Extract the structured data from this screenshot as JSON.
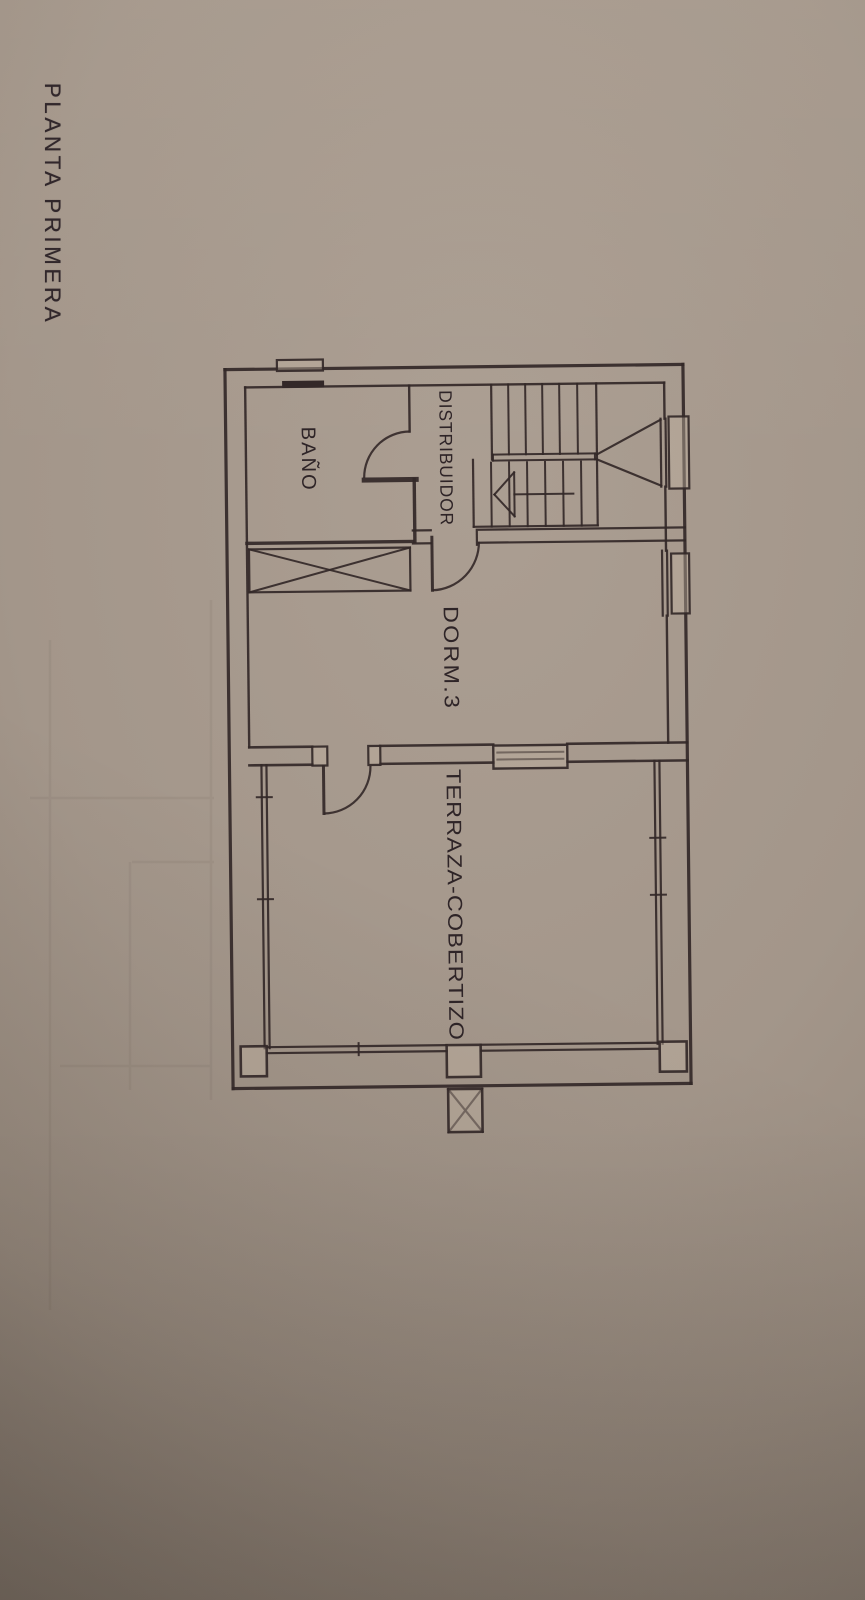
{
  "page": {
    "title": "PLANTA PRIMERA"
  },
  "floor_plan": {
    "ink": "#332828",
    "paper_fill": "rgba(192,178,162,0.42)",
    "skew_deg": -0.65,
    "rooms": [
      {
        "id": "bano",
        "label": "BAÑO",
        "x": 305,
        "y": 425,
        "length": 65,
        "size": 20,
        "ls": 2
      },
      {
        "id": "distribuidor",
        "label": "DISTRIBUIDOR",
        "x": 443,
        "y": 390,
        "length": 136,
        "size": 18,
        "ls": 1
      },
      {
        "id": "dorm3",
        "label": "DORM.3",
        "x": 445,
        "y": 606,
        "length": 104,
        "size": 21,
        "ls": 2
      },
      {
        "id": "terraza",
        "label": "TERRAZA-COBERTIZO",
        "x": 446,
        "y": 769,
        "length": 272,
        "size": 20.5,
        "ls": 1
      }
    ],
    "lines": [
      [
        229,
        367,
        229,
        1086,
        3.2,
        "outer-wall-left"
      ],
      [
        229,
        367,
        687,
        367,
        3.2,
        "outer-wall-top"
      ],
      [
        687,
        367,
        687,
        1086,
        3.2,
        "outer-wall-right"
      ],
      [
        229,
        1086,
        687,
        1086,
        3.2,
        "outer-wall-bottom"
      ],
      [
        249,
        385,
        249,
        745,
        2.4,
        "inner-wall-left"
      ],
      [
        249,
        385,
        668,
        385,
        2.4,
        "inner-wall-top"
      ],
      [
        668,
        385,
        668,
        421,
        2.4,
        "inner-wall-right-a"
      ],
      [
        668,
        489,
        668,
        553,
        2.4,
        "inner-wall-right-b"
      ],
      [
        668,
        618,
        668,
        745,
        2.4,
        "inner-wall-right-c"
      ],
      [
        413,
        385,
        413,
        431,
        2.4,
        "bano-right-wall"
      ],
      [
        367,
        479,
        419,
        479,
        5,
        "bano-door-stub"
      ],
      [
        417,
        479,
        417,
        541,
        3.4,
        "corridor-left-wall"
      ],
      [
        249,
        541,
        415,
        541,
        3.4,
        "bano-bottom-wall"
      ],
      [
        251,
        547,
        412,
        590,
        2,
        "wardrobe-diagonal"
      ],
      [
        251,
        590,
        412,
        547,
        2,
        "wardrobe-diagonal"
      ],
      [
        415,
        530,
        433,
        530,
        2.2,
        "corridor-bottom-wall"
      ],
      [
        415,
        543,
        433,
        543,
        2.2,
        "corridor-bottom-wall"
      ],
      [
        434,
        537,
        434,
        590,
        3,
        "dorm3-door-leaf"
      ],
      [
        479,
        530,
        479,
        545,
        2.2,
        "dorm3-door-jamb"
      ],
      [
        481,
        530,
        687,
        530,
        2.2,
        "stair-bottom-wall"
      ],
      [
        481,
        543,
        687,
        543,
        2.2,
        "stair-bottom-wall"
      ],
      [
        495,
        385,
        495,
        460,
        2.2,
        "stair-left-wall-upper"
      ],
      [
        476,
        460,
        476,
        527,
        2.2,
        "stair-left-wall-lower"
      ],
      [
        600,
        385,
        600,
        527,
        2.2,
        "stair-right-wall"
      ],
      [
        476,
        527,
        600,
        527,
        2.2,
        "stair-bottom-edge"
      ],
      [
        512,
        385,
        512,
        455,
        2,
        "stair-tread"
      ],
      [
        529,
        385,
        529,
        455,
        2,
        "stair-tread"
      ],
      [
        546,
        385,
        546,
        455,
        2,
        "stair-tread"
      ],
      [
        563,
        385,
        563,
        455,
        2,
        "stair-tread"
      ],
      [
        581,
        385,
        581,
        455,
        2,
        "stair-tread"
      ],
      [
        496,
        455,
        598,
        455,
        2,
        "stair-handrail"
      ],
      [
        496,
        461,
        598,
        461,
        2,
        "stair-handrail"
      ],
      [
        496,
        455,
        496,
        461,
        2,
        "stair-handrail-cap"
      ],
      [
        598,
        455,
        598,
        461,
        2,
        "stair-handrail-cap"
      ],
      [
        494,
        463,
        494,
        527,
        2,
        "stair-tread"
      ],
      [
        512,
        463,
        512,
        527,
        2,
        "stair-tread"
      ],
      [
        530,
        463,
        530,
        527,
        2,
        "stair-tread"
      ],
      [
        548,
        463,
        548,
        527,
        2,
        "stair-tread"
      ],
      [
        566,
        463,
        566,
        527,
        2,
        "stair-tread"
      ],
      [
        584,
        463,
        584,
        527,
        2,
        "stair-tread"
      ],
      [
        517,
        473,
        517,
        517,
        2,
        "stair-arrow-base"
      ],
      [
        517,
        473,
        497,
        495,
        2,
        "stair-arrow-head"
      ],
      [
        517,
        517,
        497,
        495,
        2,
        "stair-arrow-head"
      ],
      [
        517,
        495,
        576,
        495,
        2,
        "stair-arrow-shaft"
      ],
      [
        600,
        456,
        664,
        422,
        2.2,
        "stair-landing-splay"
      ],
      [
        600,
        461,
        664,
        488,
        2.2,
        "stair-landing-splay"
      ],
      [
        664,
        421,
        664,
        489,
        2.2,
        "stair-window"
      ],
      [
        669,
        421,
        669,
        489,
        2.2,
        "stair-window"
      ],
      [
        664,
        553,
        664,
        618,
        2.2,
        "dorm3-window"
      ],
      [
        669,
        553,
        669,
        618,
        2.2,
        "dorm3-window"
      ],
      [
        249,
        745,
        312,
        745,
        2.6,
        "dorm3-bottom-wall"
      ],
      [
        380,
        745,
        493,
        745,
        2.6,
        "dorm3-bottom-wall"
      ],
      [
        567,
        745,
        687,
        745,
        2.6,
        "dorm3-bottom-wall"
      ],
      [
        249,
        763,
        312,
        763,
        2.6,
        "dorm3-bottom-wall"
      ],
      [
        380,
        763,
        493,
        763,
        2.6,
        "dorm3-bottom-wall"
      ],
      [
        567,
        763,
        687,
        763,
        2.6,
        "dorm3-bottom-wall"
      ],
      [
        497,
        753,
        563,
        753,
        2,
        "terraza-window-pane"
      ],
      [
        497,
        760,
        563,
        760,
        2,
        "terraza-window-pane"
      ],
      [
        323,
        765,
        323,
        812,
        3,
        "terraza-door-leaf"
      ],
      [
        261,
        763,
        261,
        1046,
        2.2,
        "terraza-wall-left"
      ],
      [
        266,
        763,
        266,
        1046,
        2.2,
        "terraza-wall-left"
      ],
      [
        654,
        763,
        654,
        1046,
        2.2,
        "terraza-wall-right"
      ],
      [
        659,
        763,
        659,
        1046,
        2.2,
        "terraza-wall-right"
      ],
      [
        263,
        1045,
        443,
        1045,
        2.2,
        "terraza-wall-bottom"
      ],
      [
        263,
        1051,
        443,
        1051,
        2.2,
        "terraza-wall-bottom"
      ],
      [
        477,
        1045,
        654,
        1045,
        2.2,
        "terraza-wall-bottom"
      ],
      [
        477,
        1051,
        654,
        1051,
        2.2,
        "terraza-wall-bottom"
      ],
      [
        355,
        1042,
        355,
        1054,
        2,
        "terraza-wall-tick"
      ],
      [
        256,
        795,
        271,
        795,
        2,
        "terraza-wall-tick"
      ],
      [
        256,
        897,
        271,
        897,
        2,
        "terraza-wall-tick"
      ],
      [
        649,
        840,
        664,
        840,
        2,
        "terraza-wall-tick"
      ],
      [
        649,
        897,
        664,
        897,
        2,
        "terraza-wall-tick"
      ],
      [
        444,
        1089,
        478,
        1132,
        2.2,
        "pillar-cross"
      ],
      [
        444,
        1132,
        478,
        1089,
        2.2,
        "pillar-cross"
      ]
    ],
    "rects": [
      [
        251,
        547,
        161,
        43,
        2.2,
        "none",
        "wardrobe"
      ],
      [
        672,
        419,
        20,
        72,
        2.2,
        "paper",
        "stair-window-sill"
      ],
      [
        673,
        556,
        18,
        60,
        2.2,
        "paper",
        "dorm3-window-sill"
      ],
      [
        281,
        358,
        46,
        11,
        2.2,
        "paper",
        "top-wall-bump"
      ],
      [
        286,
        379,
        42,
        7,
        0,
        "ink",
        "bano-window-bar"
      ],
      [
        312,
        745,
        15,
        19,
        2.2,
        "paper",
        "terraza-door-jamb-left"
      ],
      [
        368,
        745,
        12,
        19,
        2.2,
        "paper",
        "terraza-door-jamb-right"
      ],
      [
        493,
        746,
        74,
        23,
        2.4,
        "paper",
        "terraza-window"
      ],
      [
        237,
        1044,
        26,
        30,
        2.6,
        "paper",
        "terraza-post-left"
      ],
      [
        656,
        1044,
        27,
        30,
        2.6,
        "paper",
        "terraza-post-right"
      ],
      [
        443,
        1045,
        34,
        32,
        2.6,
        "paper",
        "terraza-post-center"
      ],
      [
        444,
        1089,
        34,
        43,
        2.6,
        "paper",
        "pillar-base"
      ]
    ],
    "paths": [
      [
        "M413,431 A46,46 0 0 0 367,477",
        2.2,
        "bano-door-arc"
      ],
      [
        "M434,590 A48,48 0 0 0 481,542",
        2.2,
        "dorm3-door-arc"
      ],
      [
        "M323,812 A47,47 0 0 0 370,765",
        2.2,
        "terraza-door-arc"
      ]
    ],
    "ghost_lines": [
      [
        50,
        640,
        50,
        1310
      ],
      [
        30,
        798,
        214,
        798
      ],
      [
        130,
        862,
        130,
        1090
      ],
      [
        132,
        862,
        214,
        862
      ],
      [
        60,
        1066,
        210,
        1066
      ],
      [
        211,
        600,
        211,
        1100
      ]
    ]
  }
}
